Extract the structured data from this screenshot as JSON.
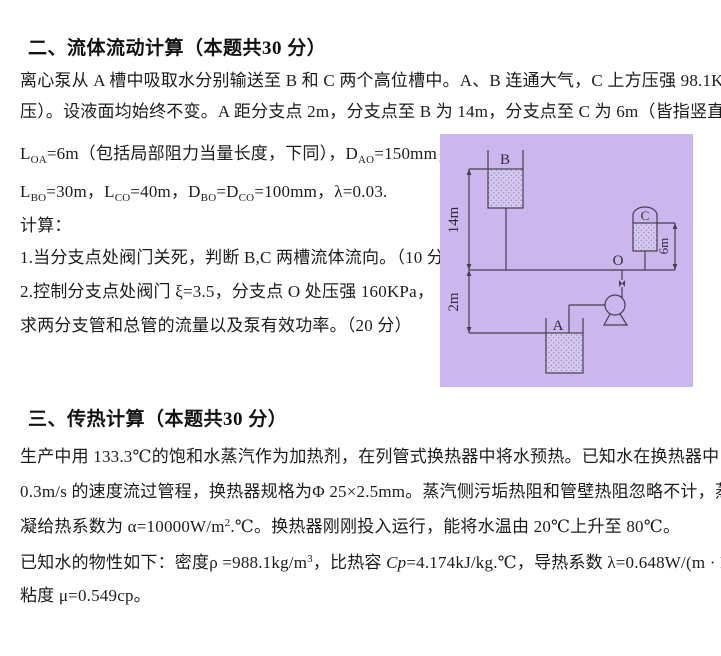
{
  "section_fluid": {
    "heading": "二、流体流动计算（本题共30 分）",
    "line1": "离心泵从 A 槽中吸取水分别输送至 B 和 C 两个高位槽中。A、B 连通大气，C 上方压强 98.1KPa（表",
    "line2": "压）。设液面均始终不变。A 距分支点 2m，分支点至 B 为 14m，分支点至 C 为 6m（皆指竖直高度）。",
    "params1": [
      {
        "t": "L"
      },
      {
        "t": "OA",
        "style": "sub"
      },
      {
        "t": "=6m（包括局部阻力当量长度，下同），D"
      },
      {
        "t": "AO",
        "style": "sub"
      },
      {
        "t": "=150mm；"
      }
    ],
    "params2": [
      {
        "t": "L"
      },
      {
        "t": "BO",
        "style": "sub"
      },
      {
        "t": "=30m，L"
      },
      {
        "t": "CO",
        "style": "sub"
      },
      {
        "t": "=40m，D"
      },
      {
        "t": "BO",
        "style": "sub"
      },
      {
        "t": "=D"
      },
      {
        "t": "CO",
        "style": "sub"
      },
      {
        "t": "=100mm，λ=0.03."
      }
    ],
    "calc_label": "计算：",
    "q1": "1.当分支点处阀门关死，判断 B,C 两槽流体流向。（10 分）",
    "q2a": "2.控制分支点处阀门 ξ=3.5，分支点 O 处压强 160KPa，",
    "q2b": "求两分支管和总管的流量以及泵有效功率。（20 分）"
  },
  "section_heat": {
    "heading": "三、传热计算（本题共30 分）",
    "line1": "生产中用 133.3℃的饱和水蒸汽作为加热剂，在列管式换热器中将水预热。已知水在换热器中以",
    "line2": "0.3m/s 的速度流过管程，换热器规格为Φ 25×2.5mm。蒸汽侧污垢热阻和管壁热阻忽略不计，蒸汽冷",
    "line3": [
      {
        "t": "凝给热系数为 α=10000W/m"
      },
      {
        "t": "2",
        "style": "sup"
      },
      {
        "t": ".℃。换热器刚刚投入运行，能将水温由 20℃上升至 80℃。"
      }
    ],
    "line4": [
      {
        "t": "已知水的物性如下：密度ρ =988.1kg/m"
      },
      {
        "t": "3",
        "style": "sup"
      },
      {
        "t": "，比热容 "
      },
      {
        "t": "Cp",
        "style": "i"
      },
      {
        "t": "=4.174kJ/kg.℃，导热系数 λ=0.648W/(m · K)，"
      }
    ],
    "line5": "粘度 μ=0.549cp。"
  },
  "diagram": {
    "bg_color": "#cbb6ee",
    "line_color": "#44404c",
    "labels": {
      "tank_b": "B",
      "tank_c": "C",
      "tank_a": "A",
      "branch_o": "O",
      "dim_14m": "14m",
      "dim_2m": "2m",
      "dim_6m": "6m"
    }
  }
}
